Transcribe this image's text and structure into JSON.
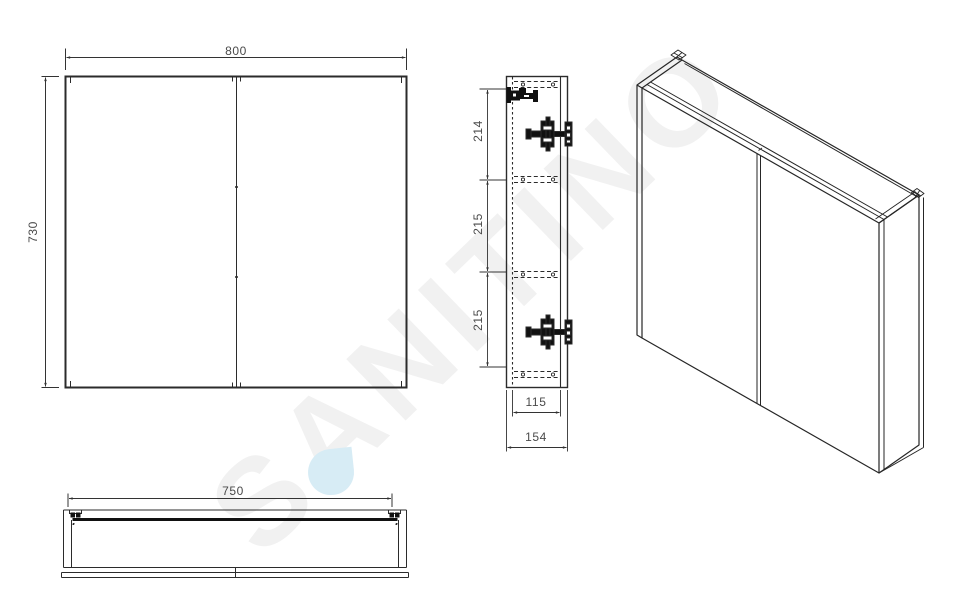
{
  "watermark": {
    "text": "SANITINO",
    "text_color": "#f1f1f1",
    "drop_color": "#d7ecf5"
  },
  "front_view": {
    "width": "800",
    "height": "730"
  },
  "side_view": {
    "segments": [
      "214",
      "215",
      "215"
    ],
    "inner_depth": "115",
    "outer_depth": "154"
  },
  "bottom_view": {
    "width": "750"
  },
  "colors": {
    "line": "#2b2b2b",
    "dim_line": "#333333",
    "dim_text": "#4a4a4a",
    "hardware": "#111111"
  }
}
